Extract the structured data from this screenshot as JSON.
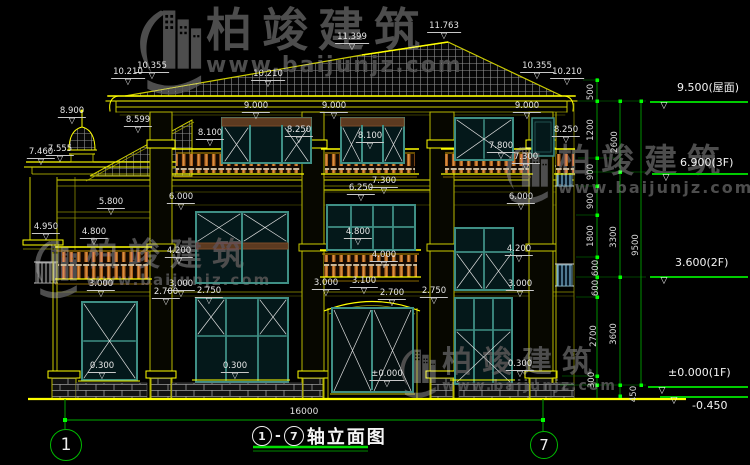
{
  "title": {
    "axis_left": "1",
    "separator": "-",
    "axis_right": "7",
    "text": "轴立面图"
  },
  "overall_dim": "16000",
  "axis_bubbles": {
    "left": "1",
    "right": "7"
  },
  "watermark": {
    "hanzi": "柏竣建筑",
    "url": "www.baijunjz.com",
    "instances": [
      {
        "x": 138,
        "y": 6,
        "logo_w": 68,
        "logo_h": 94,
        "hanzi_size": 46,
        "url_size": 22
      },
      {
        "x": 498,
        "y": 144,
        "logo_w": 60,
        "logo_h": 64,
        "hanzi_size": 33,
        "url_size": 16
      },
      {
        "x": 28,
        "y": 238,
        "logo_w": 58,
        "logo_h": 64,
        "hanzi_size": 32,
        "url_size": 15
      },
      {
        "x": 396,
        "y": 347,
        "logo_w": 46,
        "logo_h": 54,
        "hanzi_size": 30,
        "url_size": 14
      }
    ]
  },
  "dim_labels": [
    {
      "t": "11.763",
      "x": 444,
      "y": 22
    },
    {
      "t": "11.399",
      "x": 352,
      "y": 33
    },
    {
      "t": "10.355",
      "x": 152,
      "y": 62
    },
    {
      "t": "10.210",
      "x": 128,
      "y": 68
    },
    {
      "t": "10.210",
      "x": 268,
      "y": 70
    },
    {
      "t": "10.355",
      "x": 537,
      "y": 62
    },
    {
      "t": "10.210",
      "x": 567,
      "y": 68
    },
    {
      "t": "9.000",
      "x": 256,
      "y": 102
    },
    {
      "t": "9.000",
      "x": 334,
      "y": 102
    },
    {
      "t": "9.000",
      "x": 527,
      "y": 102
    },
    {
      "t": "8.900",
      "x": 72,
      "y": 107
    },
    {
      "t": "8.599",
      "x": 138,
      "y": 116
    },
    {
      "t": "8.250",
      "x": 299,
      "y": 126
    },
    {
      "t": "8.250",
      "x": 566,
      "y": 126
    },
    {
      "t": "8.100",
      "x": 210,
      "y": 129
    },
    {
      "t": "8.100",
      "x": 370,
      "y": 132
    },
    {
      "t": "7.800",
      "x": 501,
      "y": 142
    },
    {
      "t": "7.460",
      "x": 41,
      "y": 148
    },
    {
      "t": "7.555",
      "x": 60,
      "y": 145
    },
    {
      "t": "7.300",
      "x": 384,
      "y": 177
    },
    {
      "t": "7.300",
      "x": 526,
      "y": 153
    },
    {
      "t": "6.250",
      "x": 361,
      "y": 184
    },
    {
      "t": "6.000",
      "x": 181,
      "y": 193
    },
    {
      "t": "6.000",
      "x": 521,
      "y": 193
    },
    {
      "t": "5.800",
      "x": 111,
      "y": 198
    },
    {
      "t": "4.950",
      "x": 46,
      "y": 223
    },
    {
      "t": "4.800",
      "x": 94,
      "y": 228
    },
    {
      "t": "4.800",
      "x": 358,
      "y": 228
    },
    {
      "t": "4.200",
      "x": 179,
      "y": 247
    },
    {
      "t": "4.200",
      "x": 519,
      "y": 245
    },
    {
      "t": "4.000",
      "x": 384,
      "y": 251
    },
    {
      "t": "3.100",
      "x": 364,
      "y": 277
    },
    {
      "t": "3.000",
      "x": 101,
      "y": 280
    },
    {
      "t": "3.000",
      "x": 181,
      "y": 280
    },
    {
      "t": "3.000",
      "x": 326,
      "y": 279
    },
    {
      "t": "3.000",
      "x": 520,
      "y": 280
    },
    {
      "t": "2.700",
      "x": 166,
      "y": 288
    },
    {
      "t": "2.750",
      "x": 209,
      "y": 287
    },
    {
      "t": "2.700",
      "x": 392,
      "y": 289
    },
    {
      "t": "2.750",
      "x": 434,
      "y": 287
    },
    {
      "t": "±0.000",
      "x": 387,
      "y": 370
    },
    {
      "t": "0.300",
      "x": 102,
      "y": 362
    },
    {
      "t": "0.300",
      "x": 235,
      "y": 362
    },
    {
      "t": "0.300",
      "x": 520,
      "y": 360
    }
  ],
  "vchain_labels": [
    {
      "t": "500",
      "x": 591,
      "y": 92
    },
    {
      "t": "1200",
      "x": 591,
      "y": 130
    },
    {
      "t": "900",
      "x": 591,
      "y": 172
    },
    {
      "t": "900",
      "x": 591,
      "y": 201
    },
    {
      "t": "1800",
      "x": 591,
      "y": 236
    },
    {
      "t": "600",
      "x": 596,
      "y": 268
    },
    {
      "t": "600",
      "x": 596,
      "y": 288
    },
    {
      "t": "2700",
      "x": 594,
      "y": 336
    },
    {
      "t": "300",
      "x": 592,
      "y": 380
    },
    {
      "t": "2600",
      "x": 615,
      "y": 142
    },
    {
      "t": "3300",
      "x": 614,
      "y": 237
    },
    {
      "t": "3600",
      "x": 614,
      "y": 334
    },
    {
      "t": "450",
      "x": 634,
      "y": 394
    },
    {
      "t": "9500",
      "x": 636,
      "y": 245
    }
  ],
  "level_markers": [
    {
      "t": "9.500(屋面)",
      "tx": 677,
      "ty": 79,
      "lx1": 650,
      "lx2": 748,
      "ly": 101
    },
    {
      "t": "6.900(3F)",
      "tx": 680,
      "ty": 156,
      "lx1": 652,
      "lx2": 748,
      "ly": 173
    },
    {
      "t": "3.600(2F)",
      "tx": 675,
      "ty": 256,
      "lx1": 650,
      "lx2": 748,
      "ly": 276
    },
    {
      "t": "±0.000(1F)",
      "tx": 668,
      "ty": 366,
      "lx1": 648,
      "lx2": 748,
      "ly": 386
    },
    {
      "t": "-0.450",
      "tx": 692,
      "ty": 399,
      "lx1": 660,
      "lx2": 748,
      "ly": 396
    }
  ],
  "colors": {
    "background": "#000000",
    "cad_yellow": "#ffff00",
    "dim_green": "#00cc00",
    "tick_green": "#00ff00",
    "text_white": "#e6e6e6",
    "window_teal": "#3f8f85",
    "balustrade_brown": "#b4651e",
    "watermark_gray": "#4d4d4d"
  }
}
